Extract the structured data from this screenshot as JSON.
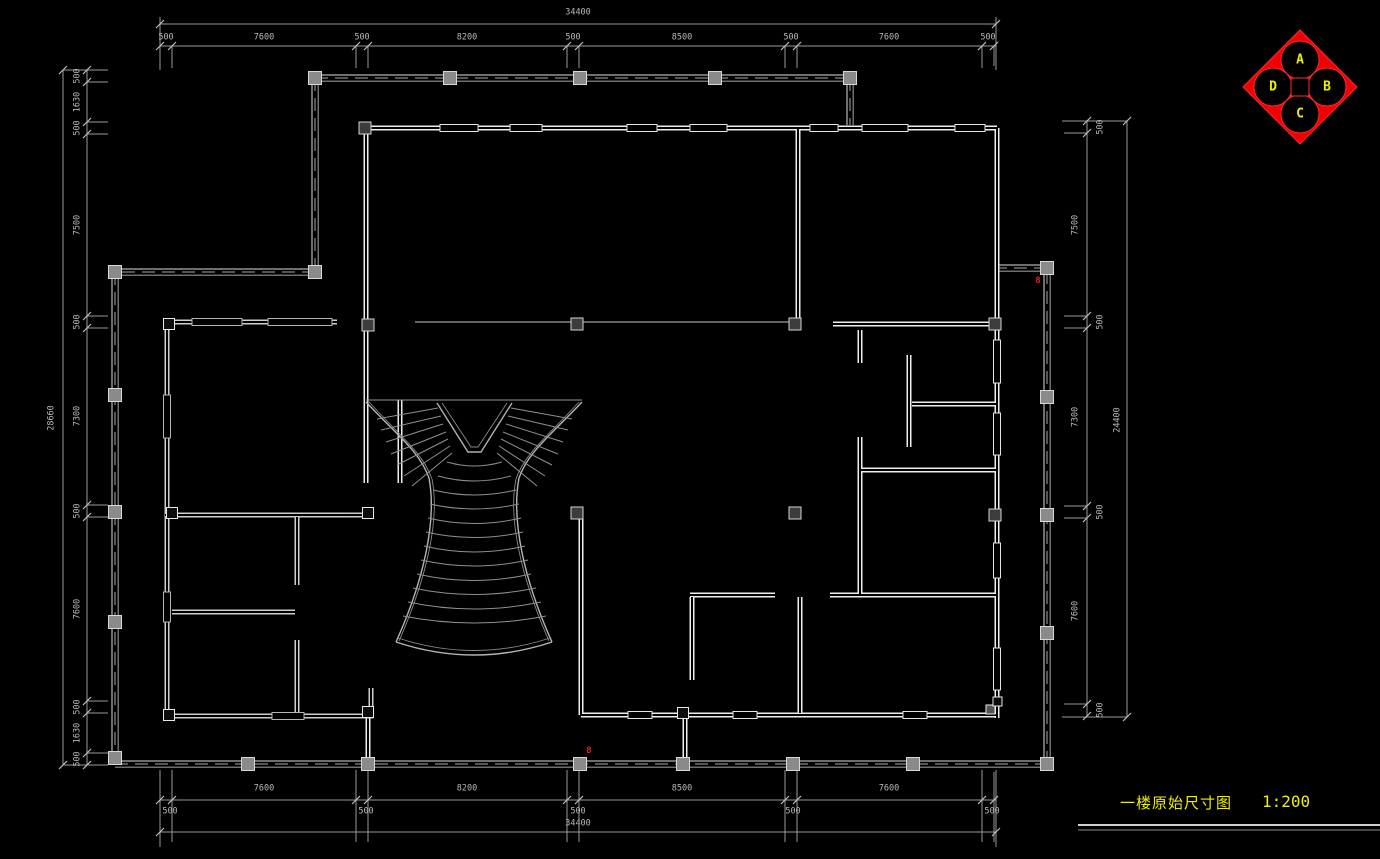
{
  "title_block": {
    "drawing_title": "一楼原始尺寸图",
    "scale_label": "1:200"
  },
  "compass": {
    "top": "A",
    "right": "B",
    "bottom": "C",
    "left": "D",
    "body_color": "#ff0000",
    "letter_color": "#f0f000"
  },
  "dimensions": {
    "top": {
      "total": "34400",
      "segments": [
        "500",
        "7600",
        "500",
        "8200",
        "500",
        "8500",
        "500",
        "7600",
        "500"
      ]
    },
    "bottom": {
      "total": "34400",
      "segments": [
        "500",
        "7600",
        "500",
        "8200",
        "500",
        "8500",
        "500",
        "7600",
        "500"
      ]
    },
    "left": {
      "total": "28660",
      "segments": [
        "500",
        "1630",
        "500",
        "7500",
        "500",
        "7300",
        "500",
        "7600",
        "500",
        "1630",
        "500"
      ]
    },
    "right": {
      "total": "24400",
      "segments": [
        "500",
        "7500",
        "500",
        "7300",
        "500",
        "7600",
        "500"
      ]
    }
  },
  "annotations": {
    "red_mark_1": "8",
    "red_mark_2": "8"
  },
  "colors": {
    "background": "#000000",
    "wall_gray": "#6e6e6e",
    "wall_white": "#ededed",
    "dim_gray": "#9a9a9a",
    "title_yellow": "#f0f000",
    "compass_red": "#ff0000"
  }
}
